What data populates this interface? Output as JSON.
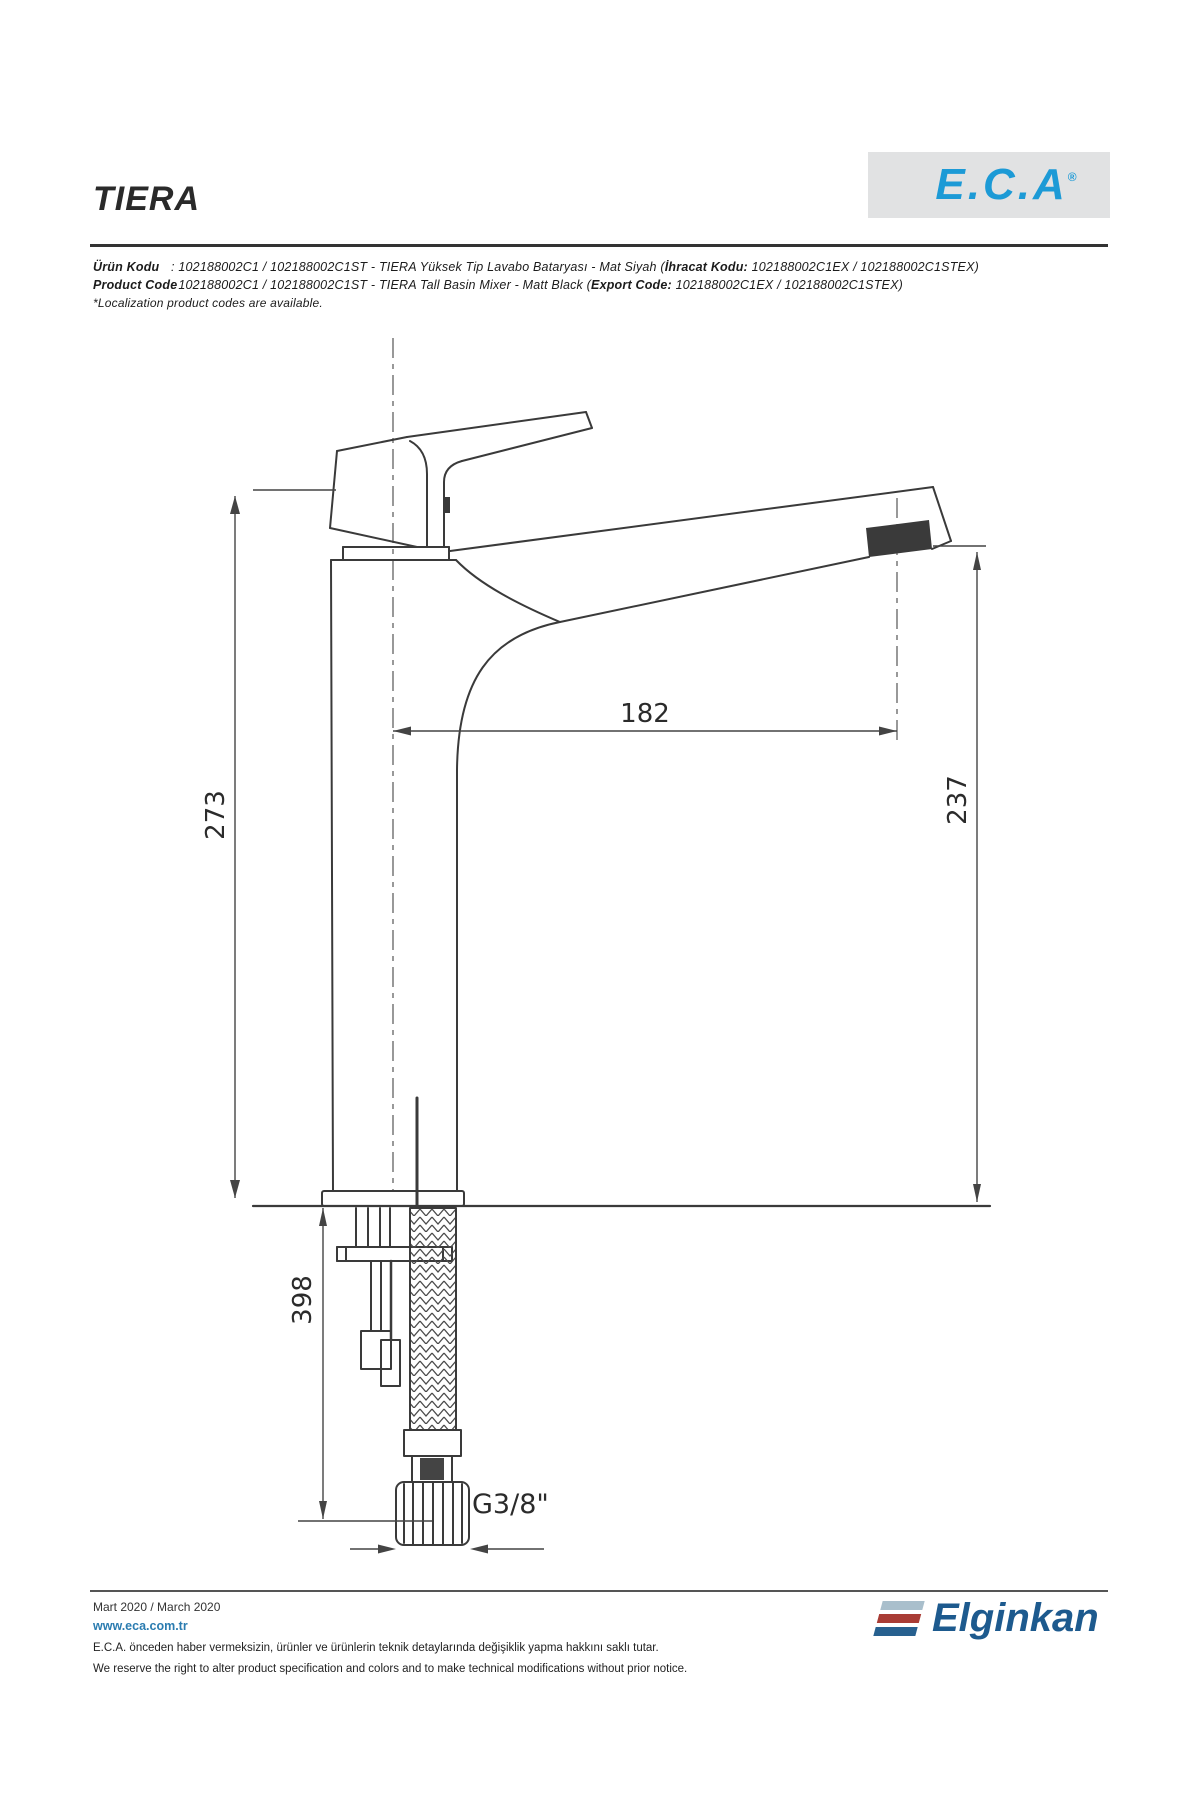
{
  "header": {
    "title": "TIERA",
    "eca_logo": {
      "text": "E.C.A",
      "reg": "®",
      "color": "#1c9ad6",
      "bg": "#e1e2e3"
    },
    "product_lines": {
      "line1_label": "Ürün Kodu",
      "line1_colon": ": ",
      "line1_text": "102188002C1 / 102188002C1ST - TIERA Yüksek Tip Lavabo Bataryası - Mat Siyah (",
      "line1_export_label": "İhracat Kodu:",
      "line1_export_text": " 102188002C1EX / 102188002C1STEX)",
      "line2_label": "Product Code",
      "line2_colon": ": ",
      "line2_text": "102188002C1 / 102188002C1ST - TIERA Tall Basin Mixer - Matt Black (",
      "line2_export_label": "Export Code:",
      "line2_export_text": " 102188002C1EX / 102188002C1STEX)",
      "note": "*Localization product codes are available."
    }
  },
  "drawing": {
    "line_color": "#3a3a3a",
    "dimensions": {
      "total_height": "273",
      "spout_reach": "182",
      "spout_height": "237",
      "hose_length": "398",
      "connection_thread": "G3/8\""
    }
  },
  "footer": {
    "date": "Mart 2020 / March 2020",
    "website": "www.eca.com.tr",
    "legal_tr": "E.C.A. önceden haber vermeksizin, ürünler ve ürünlerin teknik detaylarında değişiklik yapma hakkını saklı tutar.",
    "legal_en": "We reserve the right to alter product specification and colors and to make technical modifications without prior notice.",
    "elginkan_logo": {
      "text": "Elginkan",
      "color": "#1d5a8e",
      "bar_top": "#a9bfcc",
      "bar_mid": "#a93c35",
      "bar_bottom": "#27608f"
    }
  }
}
